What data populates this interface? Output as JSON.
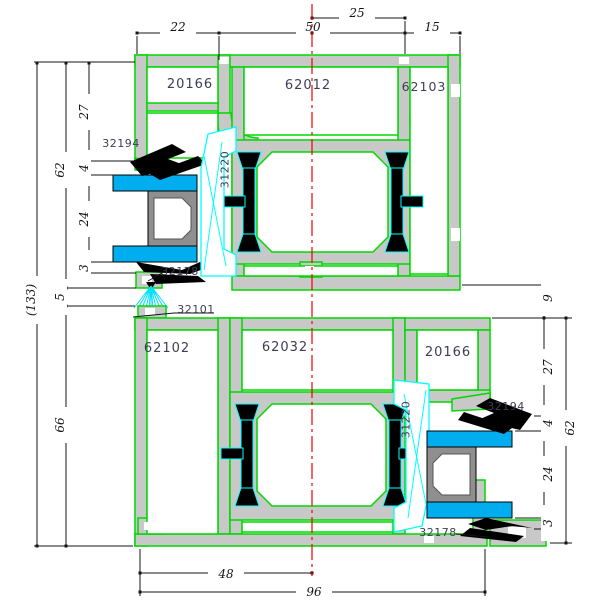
{
  "drawing_type": "aluminum-window-profile-cross-section",
  "colors": {
    "profile_outline": "#00d800",
    "profile_fill": "#c8c8c8",
    "glass_fill": "#00aeef",
    "bead_outline": "#00ffff",
    "gasket_fill": "#000000",
    "centerline": "#f00000",
    "label_text": "#3d3d57",
    "dimension_text": "#141414"
  },
  "parts": {
    "top": {
      "sash": "20166",
      "mullion": "62012",
      "frame": "62103"
    },
    "bottom": {
      "frame": "62102",
      "mullion": "62032",
      "sash": "20166"
    },
    "seals": {
      "top_outer_gasket": "32194",
      "top_glazing_bead": "31220",
      "top_inner_gasket": "32178",
      "brush_seal": "32101",
      "bottom_outer_gasket": "32194",
      "bottom_glazing_bead": "31220",
      "bottom_inner_gasket": "32178"
    }
  },
  "dimensions": {
    "top": [
      "22",
      "50",
      "25",
      "15"
    ],
    "left": [
      "27",
      "4",
      "24",
      "3",
      "62",
      "5",
      "66",
      "(133)"
    ],
    "right": [
      "9",
      "27",
      "4",
      "24",
      "3",
      "62"
    ],
    "bottom": [
      "48",
      "96"
    ]
  }
}
